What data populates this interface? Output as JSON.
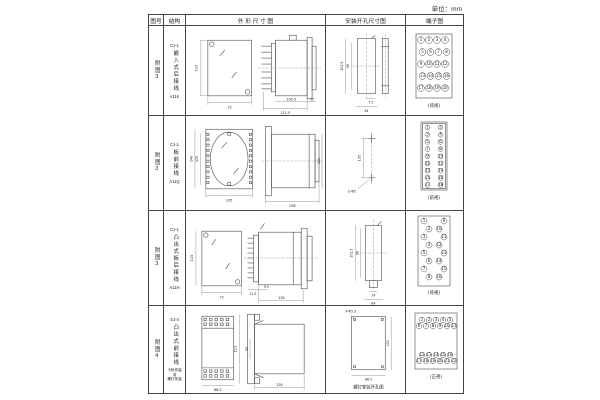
{
  "unit_label": "单位：mm",
  "header": {
    "fig": "图号",
    "struct": "结构",
    "outline": "外 形 尺 寸 图",
    "mounting": "安装开孔尺寸图",
    "terminal": "端子图"
  },
  "rows": [
    {
      "fig": "附图3",
      "model": "CJ-1",
      "struct_text": "嵌入式后接线",
      "code": "A11K",
      "outline": {
        "front_h": "115",
        "front_w": "72",
        "body_len": "100.5",
        "overall_len": "111.5",
        "flange": "15"
      },
      "mounting": {
        "v_outer": "101.5",
        "v_inner": "98",
        "h_small": "7.5",
        "h_wide": "64"
      },
      "terminal": {
        "label": "(背视)",
        "numbers": [
          "1",
          "2",
          "3",
          "4",
          "5",
          "6",
          "7",
          "8",
          "9",
          "10",
          "11",
          "12",
          "13",
          "14",
          "15",
          "16",
          "17",
          "18",
          "19",
          "20"
        ]
      }
    },
    {
      "fig": "附图3",
      "model": "CJ-1",
      "struct_text": "板前接线",
      "code": "A11Q",
      "outline": {
        "front_h_outer": "149",
        "front_h_inner": "125",
        "front_w": "105",
        "side_len": "156",
        "side_h": "121"
      },
      "mounting": {
        "pitch": "135",
        "note": "2-Φ5"
      },
      "terminal": {
        "label": "(前视)",
        "numbers": [
          "1",
          "3",
          "5",
          "7",
          "9",
          "11",
          "13",
          "15",
          "17",
          "2",
          "4",
          "6",
          "8",
          "10",
          "12",
          "14",
          "16",
          "18"
        ]
      }
    },
    {
      "fig": "附图3",
      "model": "CJ-1",
      "struct_text": "凸出式板后接线",
      "code": "A11H",
      "outline": {
        "front_h": "115",
        "front_w": "72",
        "pin_len": "11.5",
        "gap": "9.5",
        "body_len": "126"
      },
      "mounting": {
        "v_outer": "101.5",
        "v_inner": "98",
        "h_small": "24",
        "h_wide": "64"
      },
      "terminal": {
        "label": "(背视)",
        "numbers": [
          "1",
          "2",
          "3",
          "4",
          "5",
          "6",
          "7",
          "8",
          "9",
          "10",
          "11",
          "12",
          "13",
          "14",
          "15",
          "16"
        ]
      }
    },
    {
      "fig": "附图4",
      "model": "SJ-4",
      "struct_text": "凸出式前接线",
      "note_lines": [
        "卡轨安装",
        "或",
        "螺钉安装"
      ],
      "outline": {
        "front_w": "88.5",
        "side_h": "121",
        "inner": "55",
        "body_len": "128"
      },
      "mounting": {
        "note": "4-Φ5.5",
        "v": "111",
        "w": "88.5",
        "caption": "螺钉安装开孔图"
      },
      "terminal": {
        "label": "(正视)",
        "numbers": [
          "1",
          "2",
          "3",
          "4",
          "5",
          "6",
          "7",
          "8",
          "9",
          "10",
          "11",
          "12",
          "13",
          "14",
          "15",
          "16",
          "17",
          "18",
          "19",
          "20",
          "21",
          "22"
        ]
      }
    }
  ]
}
